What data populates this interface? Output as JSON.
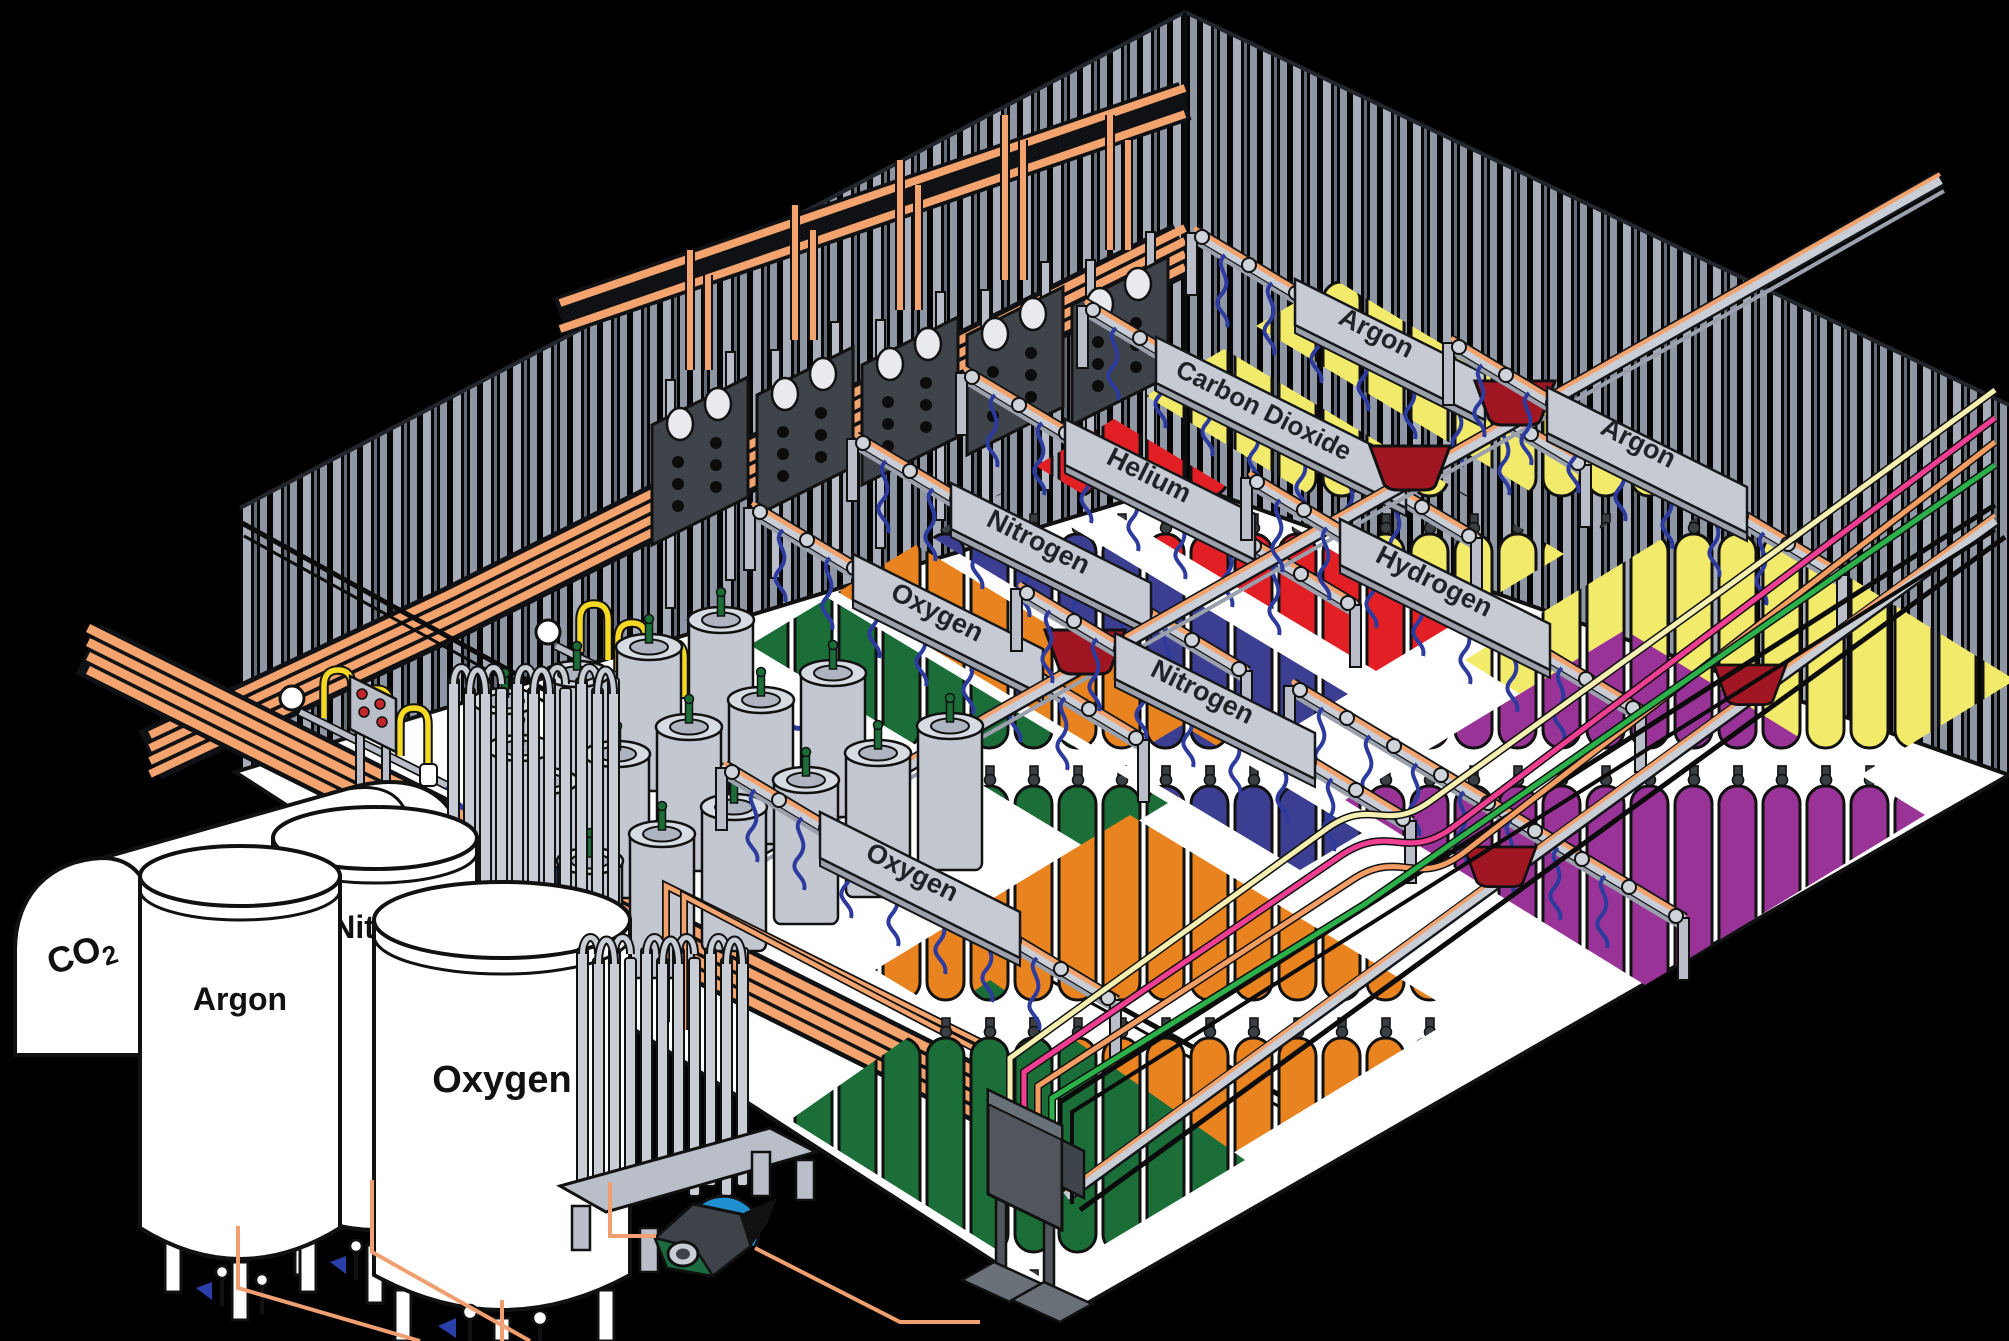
{
  "palette": {
    "background": "#000000",
    "floor": "#ffffff",
    "wall_stripe": "#a7adb9",
    "copper_pipe": "#f2a36e",
    "rail_steel": "#c9cdd6",
    "manifold_panel": "#3f444a",
    "hose_blue": "#2d3b9e",
    "hopper_red": "#a01622",
    "dewar_gray": "#c3c7d0",
    "pigtail_yellow": "#f5d923",
    "scale_platform_blue": "#2e3a8c",
    "cylinder_green": "#1b6e38",
    "cylinder_orange": "#e8831f",
    "cylinder_blue": "#3c3e92",
    "cylinder_red": "#e31f26",
    "cylinder_yellow": "#f1ea6a",
    "cylinder_purple": "#9a3397"
  },
  "bulk_storage": {
    "co2_tank": {
      "label_main": "CO",
      "label_sub": "2"
    },
    "tanks": [
      {
        "label": "Argon"
      },
      {
        "label": "Nitrogen"
      },
      {
        "label": "Oxygen"
      }
    ]
  },
  "fill_stations": [
    {
      "label": "Oxygen",
      "cylinders": "green"
    },
    {
      "label": "Nitrogen",
      "cylinders": "blue"
    },
    {
      "label": "Helium",
      "cylinders": "red"
    },
    {
      "label": "Carbon Dioxide",
      "cylinders": "yellow"
    },
    {
      "label": "Argon",
      "cylinders": "yellow"
    },
    {
      "label": "Hydrogen",
      "cylinders": "purple"
    },
    {
      "label": "Argon",
      "cylinders": "yellow"
    },
    {
      "label": "Nitrogen",
      "cylinders": "orange"
    },
    {
      "label": "Oxygen",
      "cylinders": "green"
    }
  ],
  "supply_lines": [
    {
      "name": "cream",
      "hex": "#f5efb2"
    },
    {
      "name": "pink",
      "hex": "#f03f92"
    },
    {
      "name": "orange",
      "hex": "#f49d62"
    },
    {
      "name": "green",
      "hex": "#2bb04a"
    },
    {
      "name": "copper",
      "hex": "#f2a36e"
    },
    {
      "name": "black",
      "hex": "#111111"
    }
  ]
}
